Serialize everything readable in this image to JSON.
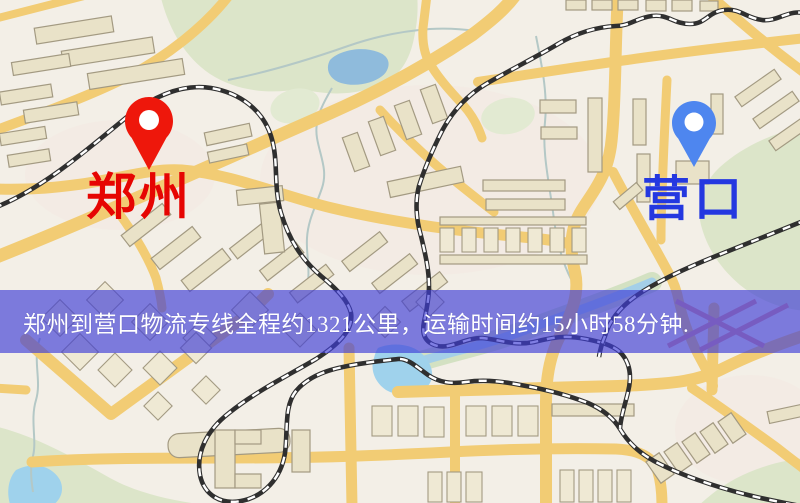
{
  "map": {
    "kind": "road-map-with-route-banner",
    "origin": {
      "label": "郑州",
      "pin_color": "#ee170b",
      "label_color": "#e60502"
    },
    "destination": {
      "label": "营口",
      "pin_color": "#4e86ef",
      "label_color": "#2438e0"
    },
    "banner": {
      "text": "郑州到营口物流专线全程约1321公里，运输时间约15小时58分钟.",
      "background_color": "rgba(62,60,214,0.66)",
      "text_color": "#ffffff"
    },
    "route": {
      "origin": "郑州",
      "destination": "营口",
      "distance_text": "约1321公里",
      "duration_text": "约15小时58分钟"
    },
    "palette": {
      "map_background": "#f3efe7",
      "road_yellow": "#f2cc74",
      "park_green": "#dce5c9",
      "water_blue": "#9fd2ec",
      "railway_dark": "#2f2f2f"
    }
  }
}
